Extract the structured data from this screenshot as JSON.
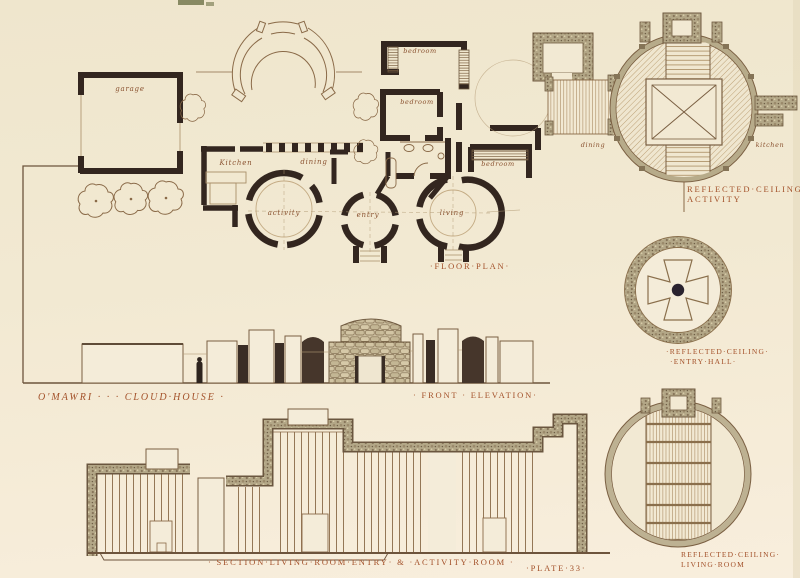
{
  "colors": {
    "paper": "#f2e9d2",
    "wall_ink": "#33261f",
    "line_ink": "#8a6a48",
    "label_red": "#a3512a",
    "poche_tan": "#b3a787"
  },
  "plan": {
    "caption": "·FLOOR·PLAN·",
    "garage": "garage",
    "kitchen": "Kitchen",
    "dining": "dining",
    "bedroom_1": "bedroom",
    "bedroom_2": "bedroom",
    "bedroom_3": "bedroom",
    "activity": "activity",
    "entry": "entry",
    "living": "living"
  },
  "rc_activity": {
    "line1": "REFLECTED·CEILING·",
    "line2": "ACTIVITY",
    "dining": "dining",
    "kitchen": "kitchen"
  },
  "rc_entry": {
    "line1": "·REFLECTED·CEILING·",
    "line2": "·ENTRY·HALL·"
  },
  "rc_living": {
    "line1": "REFLECTED·CEILING·",
    "line2": "LIVING·ROOM"
  },
  "elevation": {
    "title": "O'MAWRI · · ·  CLOUD·HOUSE ·",
    "caption": "· FRONT · ELEVATION·"
  },
  "section": {
    "caption": "· SECTION·LIVING·ROOM·ENTRY· & ·ACTIVITY·ROOM ·"
  },
  "plate": "·PLATE·33·"
}
